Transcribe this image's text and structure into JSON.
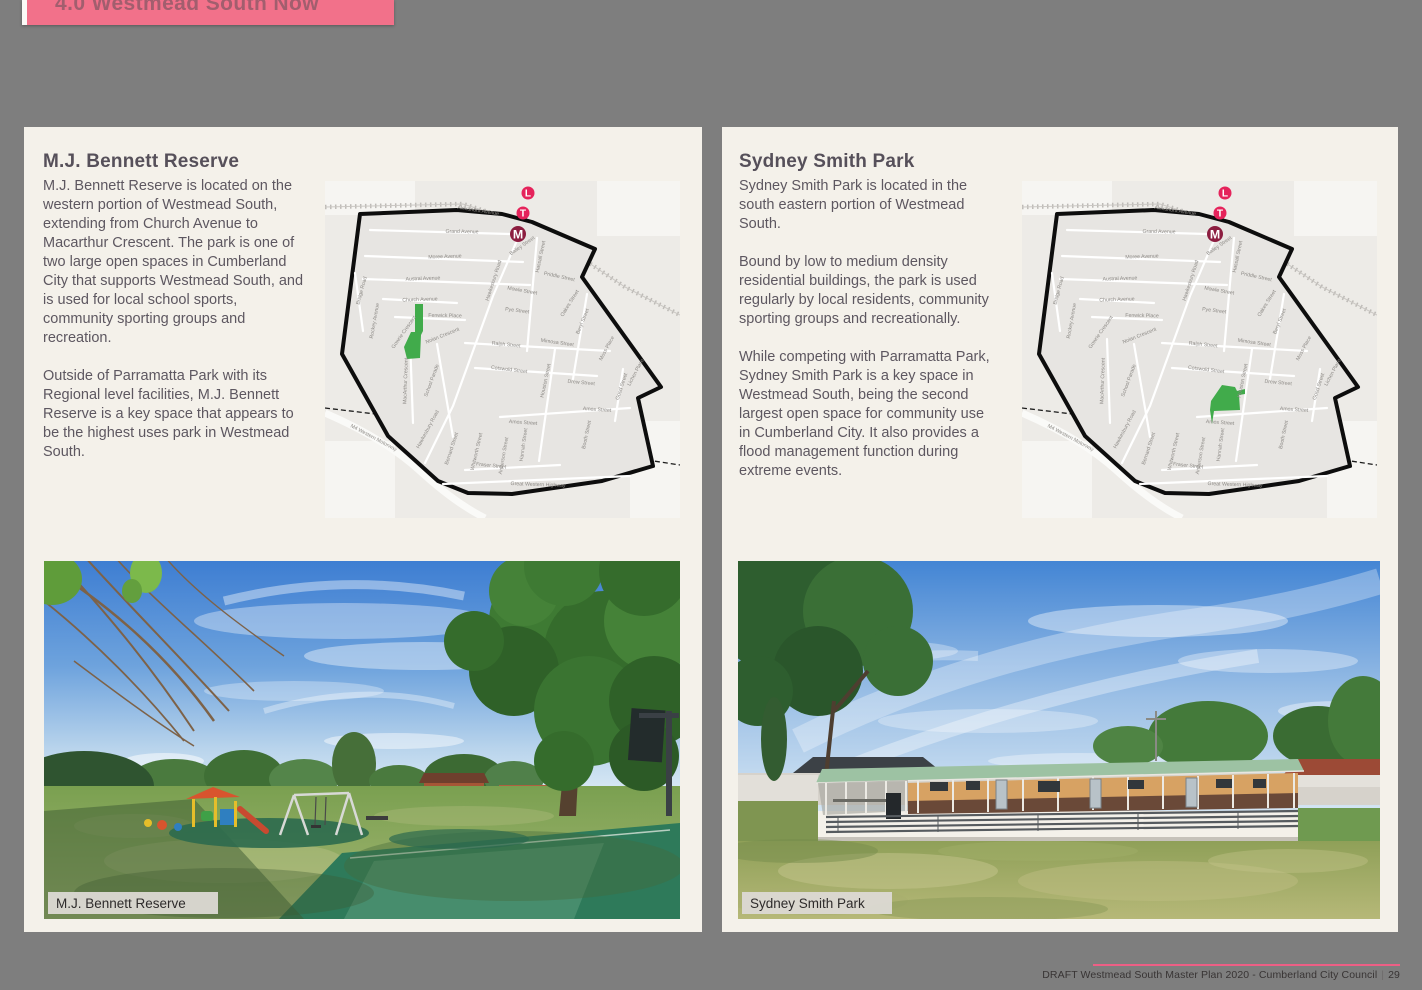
{
  "page": {
    "banner_title": "4.0 Westmead South Now",
    "footer_text": "DRAFT Westmead South Master Plan 2020 - Cumberland City Council",
    "footer_separator": "|",
    "footer_page": "29"
  },
  "colors": {
    "page_gray": "#7e7e7e",
    "panel_cream": "#f4f1ea",
    "banner_pink": "#f2718a",
    "footer_pink": "#ed5f85",
    "park_green": "#41ab4b",
    "badge_pink": "#e5235b",
    "badge_maroon": "#8c1d40"
  },
  "left_panel": {
    "heading": "M.J. Bennett Reserve",
    "paragraphs": [
      "M.J. Bennett Reserve is located on the western portion of Westmead South, extending from Church Avenue to Macarthur Crescent. The park is one of two large open spaces in Cumberland City that supports Westmead South, and is used for local school sports, community sporting groups and recreation.",
      "Outside of Parramatta Park with its Regional level facilities, M.J. Bennett Reserve is a key space that appears to be the highest uses park in Westmead South."
    ],
    "photo_caption": "M.J. Bennett Reserve"
  },
  "right_panel": {
    "heading": "Sydney Smith Park",
    "paragraphs": [
      "Sydney Smith Park is located in the south eastern portion of Westmead South.",
      "Bound by low to medium density residential buildings, the park is used regularly by local residents, community sporting groups and recreationally.",
      "While competing with Parramatta Park, Sydney Smith Park is a key space in Westmead South, being the second largest open space for community use in Cumberland City. It also provides a flood management function during extreme events."
    ],
    "photo_caption": "Sydney Smith Park"
  },
  "map": {
    "transit_badges": [
      {
        "name": "light-rail-badge",
        "label": "L",
        "x": 203,
        "y": 12,
        "rad": 6.5,
        "color": "#e5235b"
      },
      {
        "name": "train-badge",
        "label": "T",
        "x": 198,
        "y": 32,
        "rad": 6.5,
        "color": "#e5235b"
      },
      {
        "name": "metro-badge",
        "label": "M",
        "x": 193,
        "y": 53,
        "rad": 8,
        "color": "#8c1d40"
      }
    ],
    "bennett_park_points": "90,123 98,123 98,150 96,154 95,177 82,178 79,166 86,151 90,151",
    "sydney_park_points": "200,204 213,206 215,210 223,208 223,213 217,214 218,229 192,230 190,243 188,229 189,220",
    "streets": [
      {
        "label": "Alexandra Avenue",
        "x": 153,
        "y": 31,
        "r": 9
      },
      {
        "label": "Grand Avenue",
        "x": 137,
        "y": 52,
        "r": 1
      },
      {
        "label": "Moree Avenue",
        "x": 120,
        "y": 77,
        "r": -2
      },
      {
        "label": "Austral Avenue",
        "x": 98,
        "y": 99,
        "r": -2
      },
      {
        "label": "Church Avenue",
        "x": 95,
        "y": 120,
        "r": -2
      },
      {
        "label": "Fenwick Place",
        "x": 120,
        "y": 136,
        "r": 1
      },
      {
        "label": "Nolan Crescent",
        "x": 118,
        "y": 156,
        "r": -22
      },
      {
        "label": "Hawkesbury Road",
        "x": 170,
        "y": 100,
        "r": -72
      },
      {
        "label": "Hawkesbury Road",
        "x": 104,
        "y": 249,
        "r": -62
      },
      {
        "label": "Bridge Road",
        "x": 38,
        "y": 110,
        "r": -75
      },
      {
        "label": "Rockey Avenue",
        "x": 51,
        "y": 140,
        "r": -80
      },
      {
        "label": "Gowrie Crescent",
        "x": 80,
        "y": 152,
        "r": -55
      },
      {
        "label": "MacArthur Crescent",
        "x": 82,
        "y": 200,
        "r": -88
      },
      {
        "label": "School Parade",
        "x": 108,
        "y": 200,
        "r": -70
      },
      {
        "label": "Bailey Street",
        "x": 198,
        "y": 66,
        "r": -35
      },
      {
        "label": "Hassall Street",
        "x": 217,
        "y": 76,
        "r": -78
      },
      {
        "label": "Priddle Street",
        "x": 234,
        "y": 97,
        "r": 12
      },
      {
        "label": "Mowle Street",
        "x": 197,
        "y": 111,
        "r": 10
      },
      {
        "label": "Pye Street",
        "x": 192,
        "y": 131,
        "r": 7
      },
      {
        "label": "Oakes Street",
        "x": 246,
        "y": 123,
        "r": -58
      },
      {
        "label": "Beryl Street",
        "x": 259,
        "y": 141,
        "r": -68
      },
      {
        "label": "Ralph Street",
        "x": 181,
        "y": 165,
        "r": 6
      },
      {
        "label": "Mimosa Street",
        "x": 232,
        "y": 163,
        "r": 8
      },
      {
        "label": "Moss Place",
        "x": 283,
        "y": 168,
        "r": -62
      },
      {
        "label": "Cotswold Street",
        "x": 184,
        "y": 190,
        "r": 7
      },
      {
        "label": "Houston Street",
        "x": 222,
        "y": 200,
        "r": -78
      },
      {
        "label": "Drew Street",
        "x": 256,
        "y": 203,
        "r": 5
      },
      {
        "label": "Good Street",
        "x": 298,
        "y": 206,
        "r": -72
      },
      {
        "label": "Lichen Place",
        "x": 312,
        "y": 192,
        "r": -62
      },
      {
        "label": "Amos Street",
        "x": 272,
        "y": 230,
        "r": 4
      },
      {
        "label": "Amos Street",
        "x": 198,
        "y": 243,
        "r": 4
      },
      {
        "label": "Booth Street",
        "x": 263,
        "y": 254,
        "r": -78
      },
      {
        "label": "Hannah Street",
        "x": 200,
        "y": 264,
        "r": -82
      },
      {
        "label": "Anderson Street",
        "x": 180,
        "y": 275,
        "r": -80
      },
      {
        "label": "Fraser Street",
        "x": 166,
        "y": 286,
        "r": 6
      },
      {
        "label": "Whitworth Street",
        "x": 153,
        "y": 271,
        "r": -77
      },
      {
        "label": "Bernard Street",
        "x": 128,
        "y": 268,
        "r": -72
      },
      {
        "label": "Great Western Highway",
        "x": 213,
        "y": 305,
        "r": 2
      },
      {
        "label": "M4 Western Motorway",
        "x": 48,
        "y": 258,
        "r": 28
      }
    ]
  }
}
